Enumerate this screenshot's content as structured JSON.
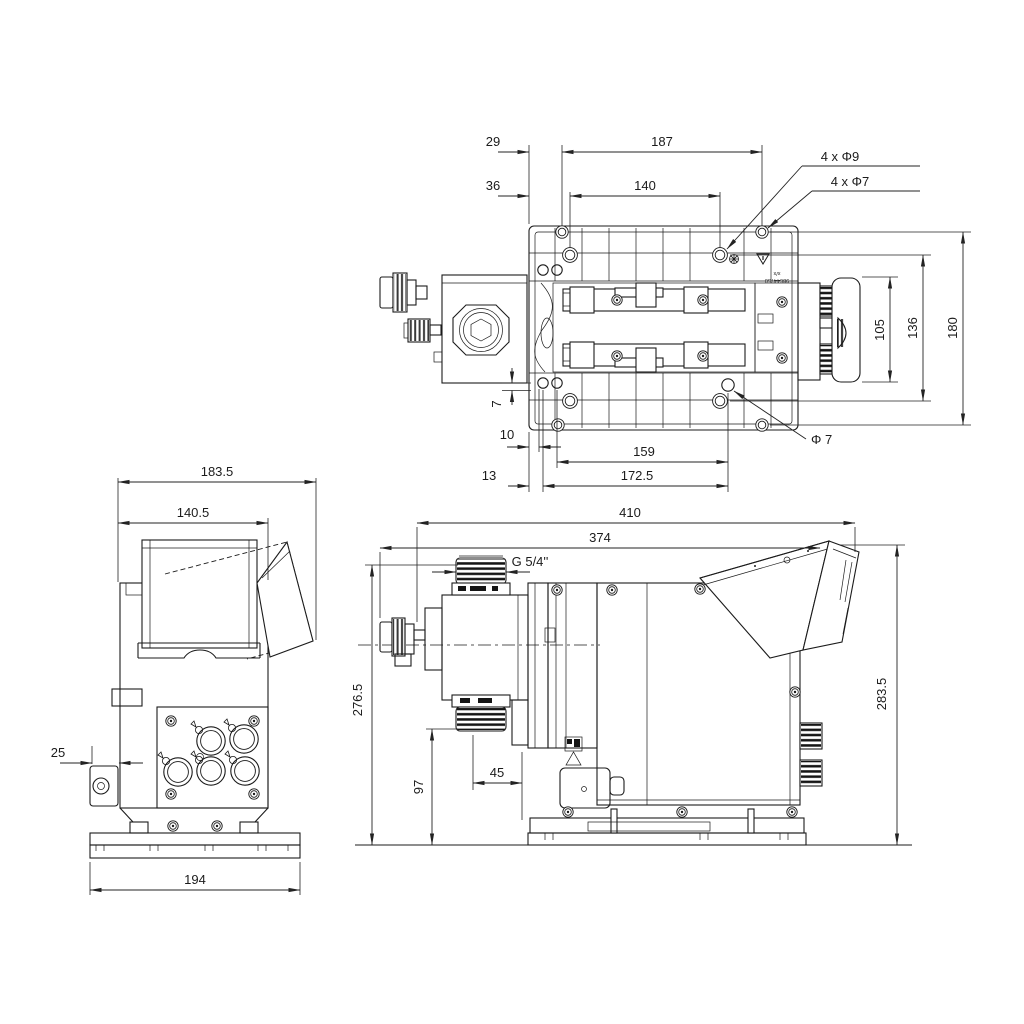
{
  "drawing": {
    "colors": {
      "background": "#ffffff",
      "line": "#1b1b1b",
      "dimension": "#232323"
    },
    "views": {
      "bottom_view": {
        "dims": {
          "d29": "29",
          "d187": "187",
          "d36": "36",
          "d140": "140",
          "holes_phi9": "4 x Φ9",
          "holes_phi7": "4 x Φ7",
          "d105": "105",
          "d136": "136",
          "d180": "180",
          "d7": "7",
          "d10": "10",
          "d159": "159",
          "phi7": "Φ 7",
          "d13": "13",
          "d172_5": "172.5"
        },
        "labels": {
          "type": "x/x",
          "part_no": "98644750"
        }
      },
      "front_view": {
        "dims": {
          "d183_5": "183.5",
          "d140_5": "140.5",
          "d25": "25",
          "d194": "194"
        }
      },
      "side_view": {
        "dims": {
          "d410": "410",
          "d374": "374",
          "thread": "G 5/4''",
          "d276_5": "276.5",
          "d97": "97",
          "d45": "45",
          "d283_5": "283.5"
        }
      }
    }
  }
}
